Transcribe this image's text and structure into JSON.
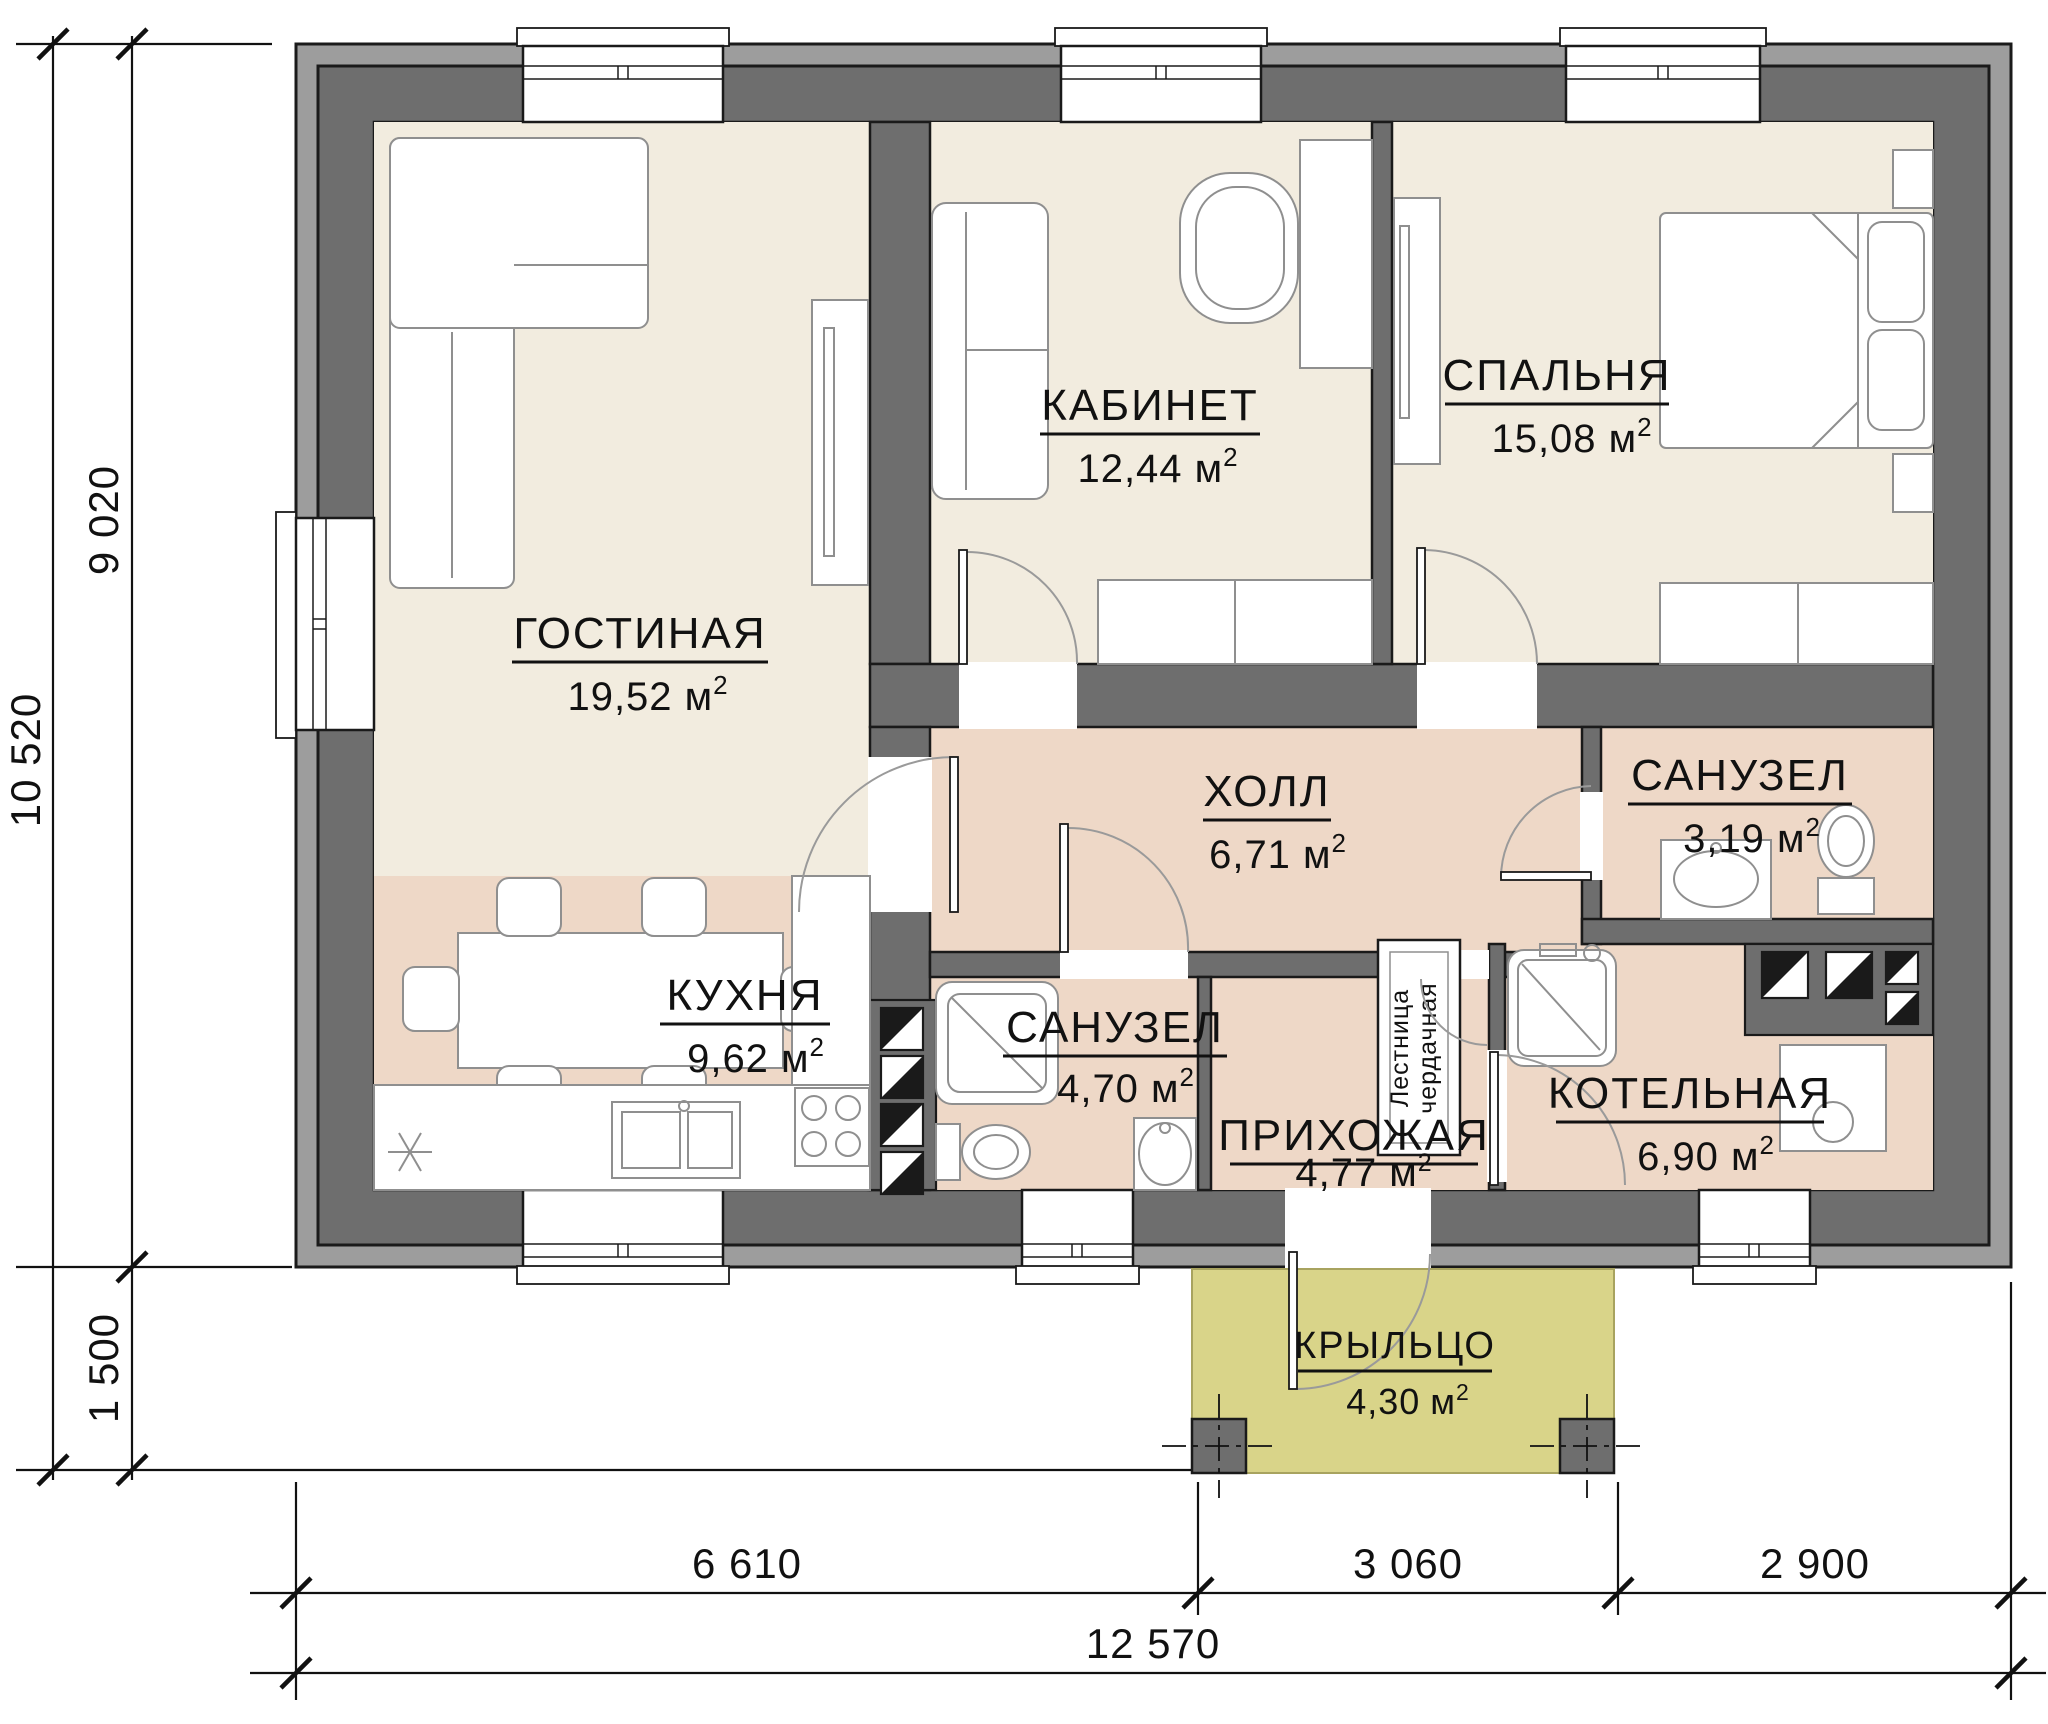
{
  "drawing": {
    "type": "floor-plan",
    "labels": {
      "unit": "м",
      "sup": "2"
    },
    "rooms": [
      {
        "id": "living",
        "name": "ГОСТИНАЯ",
        "area": "19,52"
      },
      {
        "id": "office",
        "name": "КАБИНЕТ",
        "area": "12,44"
      },
      {
        "id": "bedroom",
        "name": "СПАЛЬНЯ",
        "area": "15,08"
      },
      {
        "id": "hall",
        "name": "ХОЛЛ",
        "area": "6,71"
      },
      {
        "id": "wc-top",
        "name": "САНУЗЕЛ",
        "area": "3,19"
      },
      {
        "id": "kitchen",
        "name": "КУХНЯ",
        "area": "9,62"
      },
      {
        "id": "wc-low",
        "name": "САНУЗЕЛ",
        "area": "4,70"
      },
      {
        "id": "entry",
        "name": "ПРИХОЖАЯ",
        "area": "4,77"
      },
      {
        "id": "boiler",
        "name": "КОТЕЛЬНАЯ",
        "area": "6,90"
      },
      {
        "id": "porch",
        "name": "КРЫЛЬЦО",
        "area": "4,30"
      }
    ],
    "annotations": {
      "attic_ladder_line1": "Лестница",
      "attic_ladder_line2": "чердачная"
    },
    "dimensions": {
      "left_total": "10 520",
      "left_main": "9 020",
      "left_porch": "1 500",
      "bottom_left": "6 610",
      "bottom_mid": "3 060",
      "bottom_right": "2 900",
      "bottom_total": "12 570"
    },
    "colors": {
      "wall_dark": "#6e6e6e",
      "wall_light": "#9d9d9d",
      "floor_beige": "#f2ecdf",
      "floor_pink": "#eed8c7",
      "porch_khaki": "#d9d489",
      "line": "#1a1a1a"
    }
  }
}
